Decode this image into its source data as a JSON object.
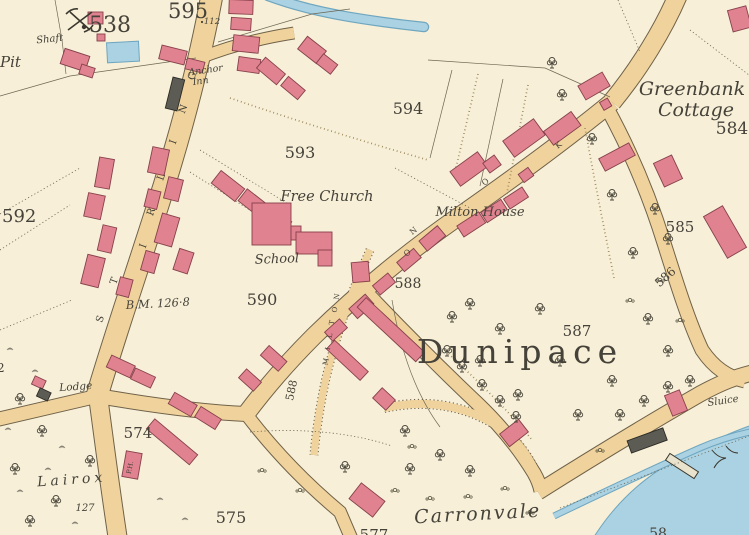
{
  "colors": {
    "paper": "#f7efd7",
    "road": "#f0d39c",
    "building": "#e0828f",
    "building_outline": "#86414c",
    "water": "#abd2e2",
    "water_deep": "#6fa6c0",
    "ink": "#45423a"
  },
  "place_labels": {
    "pit": "Pit",
    "shaft": "Shaft",
    "anchor_inn_line1": "Anchor",
    "anchor_inn_line2": "Inn",
    "greenbank_line1": "Greenbank",
    "greenbank_line2": "Cottage",
    "free_church": "Free Church",
    "school": "School",
    "milton_house": "Milton House",
    "dunipace": "Dunipace",
    "lodge": "Lodge",
    "lairox": "Lairox",
    "carronvale": "Carronvale",
    "sluice": "Sluice",
    "public_house": "P.H.",
    "benchmark": "B.M. 126·8",
    "spot_height": "112"
  },
  "parcel_numbers": {
    "p538": "538",
    "p595": "595",
    "p594": "594",
    "p593": "593",
    "p592": "592",
    "p590": "590",
    "p588": "588",
    "p588_road": "588",
    "p587": "587",
    "p586": "586",
    "p585": "585",
    "p584": "584",
    "p574": "574",
    "p575": "575",
    "p577": "577",
    "p127": "127",
    "p58_partial": "58",
    "p2_partial": "2"
  },
  "road_letters": {
    "stirling": [
      "S",
      "T",
      "I",
      "R",
      "L",
      "I",
      "N",
      "G"
    ],
    "lane": [
      "M",
      "I",
      "L",
      "T",
      "O",
      "N"
    ],
    "street": [
      "O",
      "K",
      "N",
      "O"
    ]
  }
}
